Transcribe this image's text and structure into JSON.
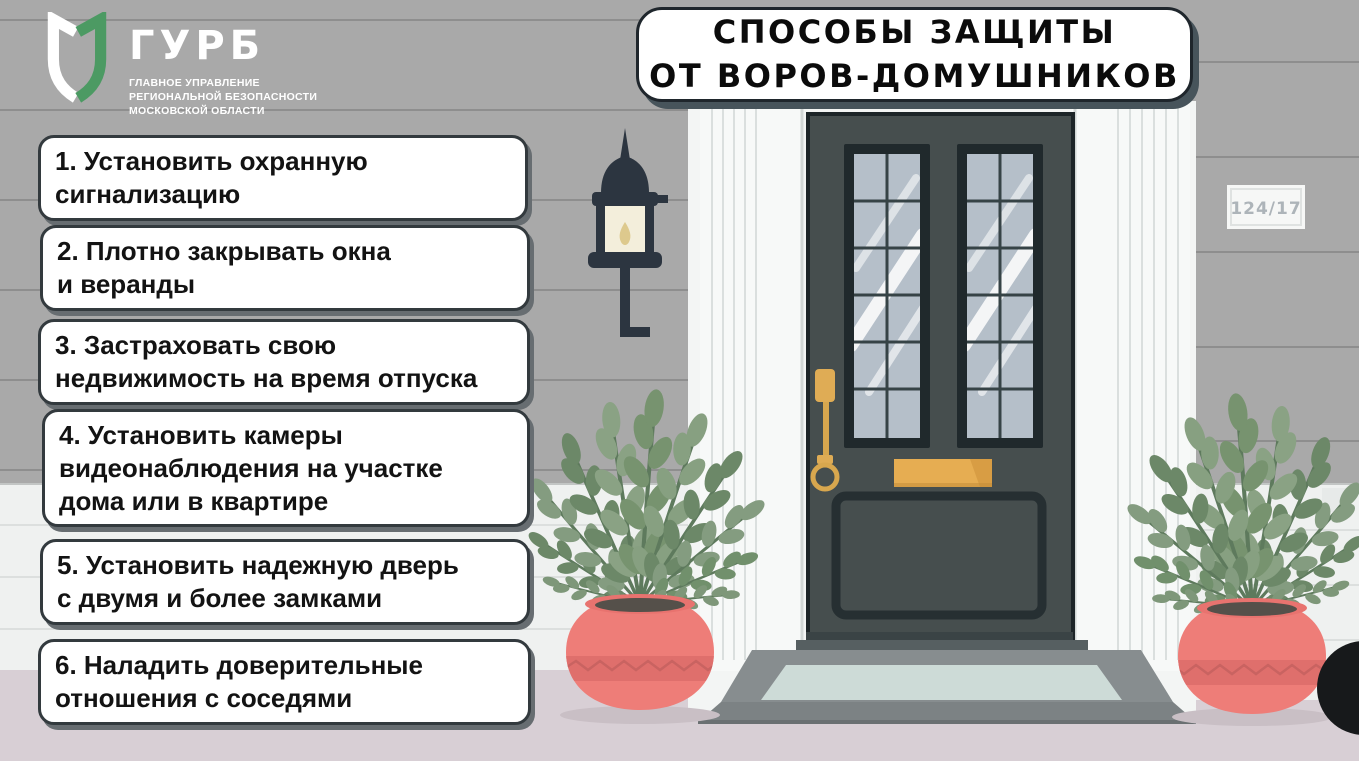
{
  "header": {
    "logo": {
      "acronym": "ГУРБ",
      "department_line1": "ГЛАВНОЕ УПРАВЛЕНИЕ",
      "department_line2": "РЕГИОНАЛЬНОЙ БЕЗОПАСНОСТИ",
      "department_line3": "МОСКОВСКОЙ ОБЛАСТИ"
    },
    "title": "СПОСОБЫ ЗАЩИТЫ\nОТ ВОРОВ-ДОМУШНИКОВ"
  },
  "tips": [
    {
      "text": "1. Установить охранную\nсигнализацию"
    },
    {
      "text": "2. Плотно закрывать окна\nи веранды"
    },
    {
      "text": "3. Застраховать свою\nнедвижимость на время отпуска"
    },
    {
      "text": "4. Установить камеры\nвидеонаблюдения на участке\nдома или в квартире"
    },
    {
      "text": "5. Установить надежную дверь\nс двумя и более замками"
    },
    {
      "text": "6. Наладить доверительные\nотношения с соседями"
    }
  ],
  "illustration": {
    "house_number": "124/17"
  },
  "colors": {
    "logo_green": "#4c9a63",
    "wall": "#a9a9a9",
    "door": "#464e4e",
    "brass": "#e6ad52",
    "pot": "#ee7d78",
    "foliage": "#7e977a",
    "ground": "#d8cfd5"
  }
}
